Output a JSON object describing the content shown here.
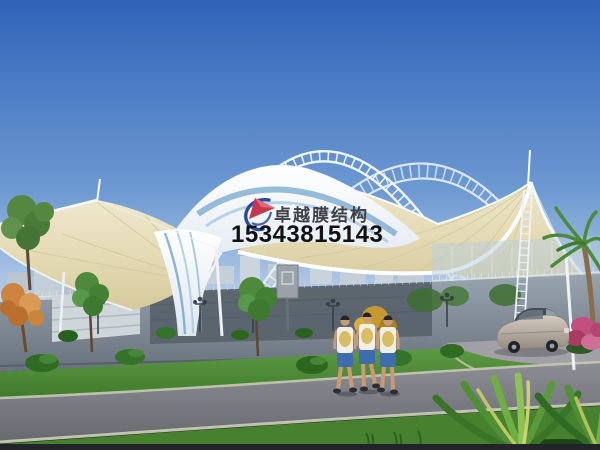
{
  "watermark": {
    "logo": "sail-swoosh-logo",
    "logo_blue": "#274b9f",
    "logo_red": "#c6374d",
    "company_name": "卓越膜结构",
    "company_color": "#3f4146",
    "phone_number": "15343815143",
    "phone_color": "#121212"
  },
  "scene": {
    "type": "architectural-rendering",
    "subject": "White tensile membrane canopy with arched steel truss over a sports court, perimeter wall, lawn with bushes and trees, road with sedan car and three pedestrians, palm and foreground plant",
    "palette": {
      "sky_top": "#2f63b8",
      "sky_mid": "#6e9ad2",
      "sky_horizon": "#d9e5f1",
      "truss_white": "#f0f5fa",
      "dome_white": "#ffffff",
      "dome_shade": "#dde6ee",
      "ridge_blue": "#6fa3cc",
      "ridge_blue_light": "#a9c8e2",
      "canopy_cream_light": "#efe8cd",
      "canopy_cream_mid": "#e3d9b2",
      "canopy_cream_dark": "#d5c99c",
      "rib_tan": "#d2c79c",
      "wall_light": "#98a4ae",
      "wall_dark": "#59636d",
      "glass_blue": "#b7cedc",
      "building_haze": "#c8d2d9",
      "lawn_light": "#63a048",
      "lawn_dark": "#3f7a2b",
      "bush_green": "#2f6b22",
      "autumn_orange": "#cd8440",
      "palm_green": "#4c8a3a",
      "flower_pink": "#c2507e",
      "road_light": "#8d8d95",
      "road_dark": "#68686f",
      "curb": "#c6c9b2",
      "pavement": "#a0a0a6",
      "car_body_light": "#d3ccc1",
      "car_body_dark": "#968b80",
      "shirt_white": "#f1efe5",
      "shorts_blue": "#3f6cae",
      "skin": "#c89b74",
      "bottom_bar": "#23232a"
    }
  }
}
